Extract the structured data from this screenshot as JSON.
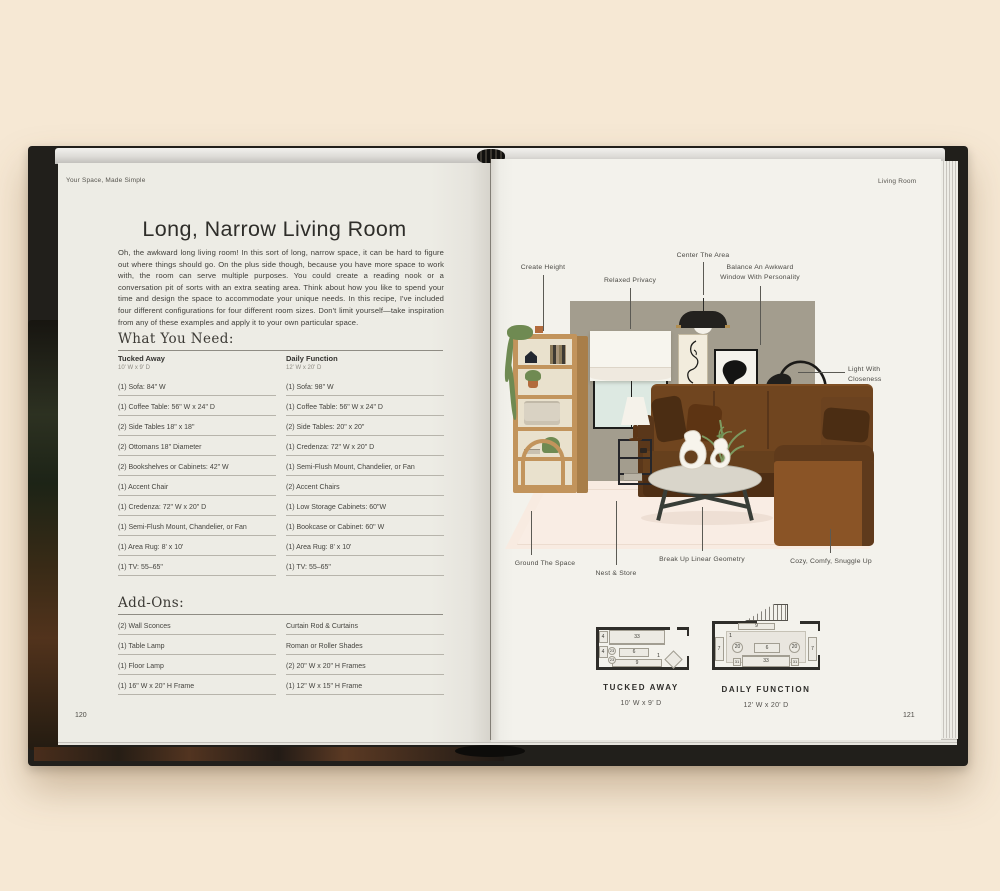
{
  "book": {
    "left_running_header": "Your Space, Made Simple",
    "right_running_header": "Living Room",
    "left_page_number": "120",
    "right_page_number": "121"
  },
  "left_page": {
    "title": "Long, Narrow Living Room",
    "intro": "Oh, the awkward long living room! In this sort of long, narrow space, it can be hard to figure out where things should go. On the plus side though, because you have more space to work with, the room can serve multiple purposes. You could create a reading nook or a conversation pit of sorts with an extra seating area. Think about how you like to spend your time and design the space to accommodate your unique needs. In this recipe, I've included four different configurations for four different room sizes. Don't limit yourself—take inspiration from any of these examples and apply it to your own particular space.",
    "what_you_need": {
      "heading": "What You Need:",
      "columns": [
        {
          "name": "Tucked Away",
          "dims": "10' W x 9' D",
          "items": [
            "(1) Sofa: 84\" W",
            "(1) Coffee Table: 56\" W x 24\" D",
            "(2) Side Tables 18\" x 18\"",
            "(2) Ottomans 18\" Diameter",
            "(2) Bookshelves or Cabinets: 42\" W",
            "(1) Accent Chair",
            "(1) Credenza: 72\" W x 20\" D",
            "(1) Semi-Flush Mount, Chandelier, or Fan",
            "(1) Area Rug: 8' x 10'",
            "(1) TV: 55–65\""
          ]
        },
        {
          "name": "Daily Function",
          "dims": "12' W x 20' D",
          "items": [
            "(1) Sofa: 98\" W",
            "(1) Coffee Table: 56\" W x 24\" D",
            "(2) Side Tables: 20\" x 20\"",
            "(1) Credenza: 72\" W x 20\" D",
            "(1) Semi-Flush Mount, Chandelier, or Fan",
            "(2) Accent Chairs",
            "(1) Low Storage Cabinets: 60\"W",
            "(1) Bookcase or Cabinet: 60\" W",
            "(1) Area Rug: 8' x 10'",
            "(1) TV: 55–65\""
          ]
        }
      ]
    },
    "add_ons": {
      "heading": "Add-Ons:",
      "columns": [
        {
          "items": [
            "(2) Wall Sconces",
            "(1) Table Lamp",
            "(1) Floor Lamp",
            "(1) 16\" W x 20\" H Frame"
          ]
        },
        {
          "items": [
            "Curtain Rod & Curtains",
            "Roman or Roller Shades",
            "(2) 20\" W x 20\" H Frames",
            "(1) 12\" W x 15\" H Frame"
          ]
        }
      ]
    }
  },
  "right_page": {
    "annotations": [
      {
        "text": "Create Height"
      },
      {
        "text": "Relaxed Privacy"
      },
      {
        "text": "Center The Area"
      },
      {
        "text": "Balance An Awkward Window With Personality"
      },
      {
        "text": "Light With Closeness"
      },
      {
        "text": "Ground The Space"
      },
      {
        "text": "Nest & Store"
      },
      {
        "text": "Break Up Linear Geometry"
      },
      {
        "text": "Cozy, Comfy, Snuggle Up"
      }
    ],
    "floor_plans": {
      "tucked_away": {
        "caption": "TUCKED AWAY",
        "dims": "10' W x 9' D",
        "sofa": "33",
        "coffee_table": "6",
        "credenza": "9",
        "side_table_1": "4",
        "side_table_2": "4",
        "ottoman_1": "23",
        "ottoman_2": "23",
        "accent_chair": "1"
      },
      "daily_function": {
        "caption": "DAILY FUNCTION",
        "dims": "12' W x 20' D",
        "credenza": "9",
        "rug": "1",
        "accent_chair_1": "20",
        "accent_chair_2": "20",
        "coffee_table": "6",
        "sofa": "33",
        "side_table_1": "31",
        "side_table_2": "31",
        "cabinet_1": "7",
        "cabinet_2": "7"
      }
    }
  },
  "palette": {
    "background": "#f6e8d4",
    "page": "#f0efe8",
    "wall": "#a39d8e",
    "sofa_brown": "#70451f",
    "wood": "#c2945c",
    "rug": "#f8ebe1",
    "cover": "#211f1b"
  }
}
